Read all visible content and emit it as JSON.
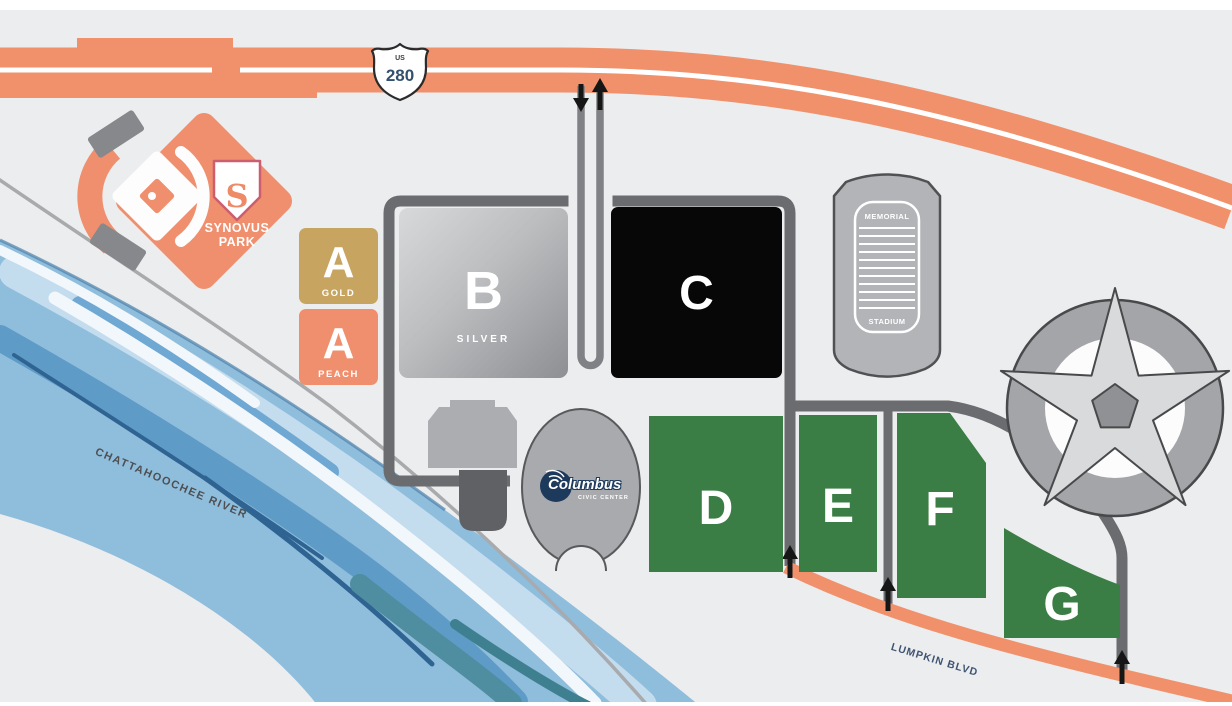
{
  "highway": {
    "shield_top": "US",
    "shield_number": "280"
  },
  "ballpark": {
    "logo_letter": "S",
    "name_line1": "SYNOVUS",
    "name_line2": "PARK"
  },
  "river": {
    "label": "CHATTAHOOCHEE RIVER"
  },
  "street": {
    "label": "LUMPKIN BLVD"
  },
  "memorial_stadium": {
    "line1": "MEMORIAL",
    "line2": "STADIUM"
  },
  "civic_center": {
    "logo_text": "Columbus",
    "logo_subtext": "CIVIC CENTER"
  },
  "lots": {
    "a_gold": {
      "letter": "A",
      "sublabel": "GOLD"
    },
    "a_peach": {
      "letter": "A",
      "sublabel": "PEACH"
    },
    "b": {
      "letter": "B",
      "sublabel": "SILVER"
    },
    "c": {
      "letter": "C"
    },
    "d": {
      "letter": "D"
    },
    "e": {
      "letter": "E"
    },
    "f": {
      "letter": "F"
    },
    "g": {
      "letter": "G"
    }
  },
  "colors": {
    "background": "#ecedee",
    "highway_salmon": "#f0916c",
    "road_dark_gray": "#6b6c6f",
    "road_medium_gray": "#7f8184",
    "lot_gold": "#c7a560",
    "lot_peach": "#ef8f6e",
    "lot_silver": "#9d9fa2",
    "lot_black": "#070708",
    "lot_green": "#3a7d45",
    "river_blue": "#8fbddc",
    "logo_navy": "#1d3a5c",
    "structure_gray": "#b2b4b7"
  }
}
